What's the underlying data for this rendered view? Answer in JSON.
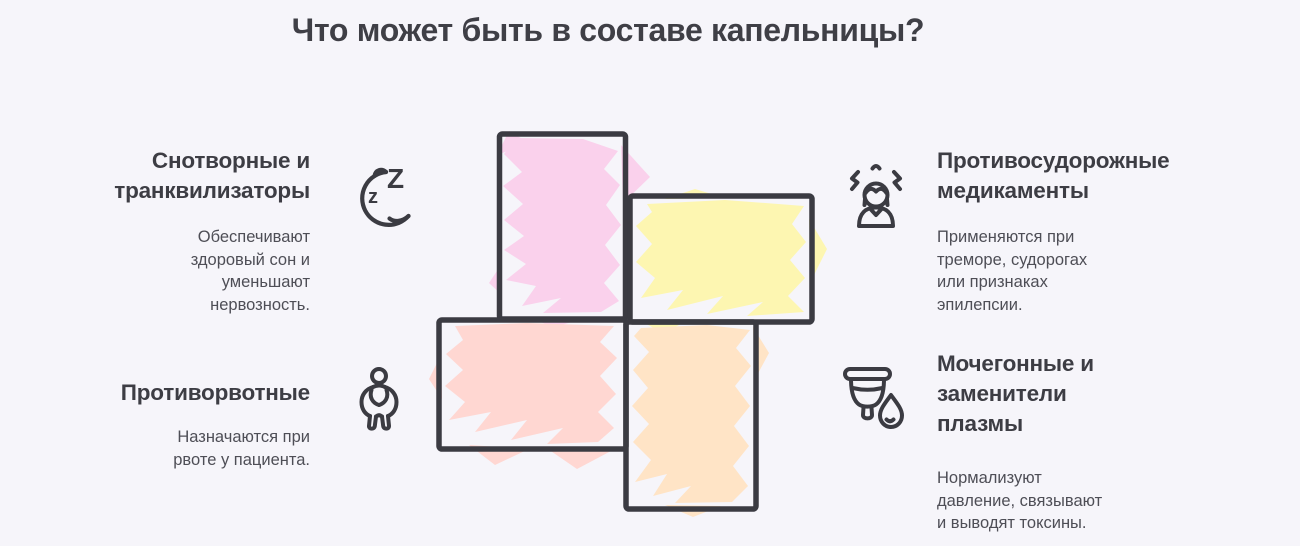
{
  "title": "Что может быть в составе капельницы?",
  "colors": {
    "background": "#f6f5fa",
    "outline": "#3b3b42",
    "heading_text": "#3d3d44",
    "body_text": "#4e4e56"
  },
  "diagram": {
    "type": "pinwheel-cross-of-scribbled-rectangles",
    "blocks": [
      {
        "name": "top-left-vertical",
        "color": "#fad1ec"
      },
      {
        "name": "top-right-horizontal",
        "color": "#fdf6b1"
      },
      {
        "name": "bottom-left-horizontal",
        "color": "#ffd7d2"
      },
      {
        "name": "bottom-right-vertical",
        "color": "#ffe4c6"
      }
    ]
  },
  "icon_text": {
    "z_big": "Z",
    "z_small": "z"
  },
  "sections": [
    {
      "heading": "Снотворные и\nтранквилизаторы",
      "description": "Обеспечивают\nздоровый сон и\nуменьшают\nнервозность.",
      "icon": "sleeping-moon-icon"
    },
    {
      "heading": "Противорвотные",
      "description": "Назначаются при\nрвоте у пациента.",
      "icon": "nauseous-person-icon"
    },
    {
      "heading": "Противосудорожные\nмедикаменты",
      "description": "Применяются при\nтреморе, судорогах\nили признаках\nэпилепсии.",
      "icon": "stressed-person-icon"
    },
    {
      "heading": "Мочегонные и\nзаменители\nплазмы",
      "description": "Нормализуют\nдавление, связывают\nи выводят токсины.",
      "icon": "cup-and-drop-icon"
    }
  ]
}
